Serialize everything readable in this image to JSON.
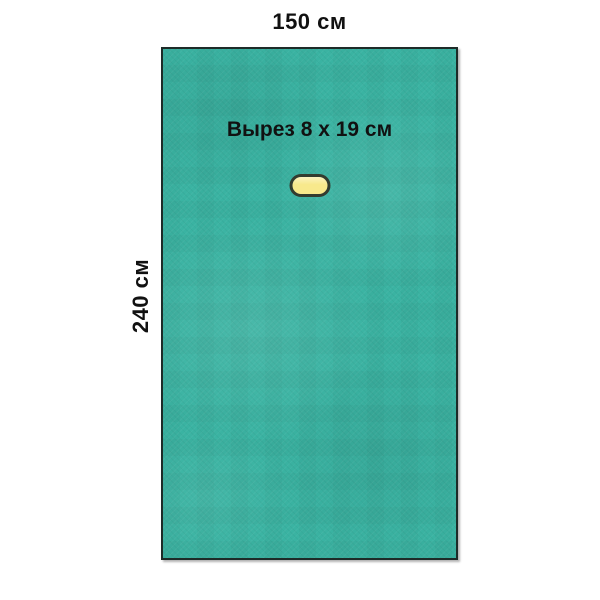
{
  "figure": {
    "top_label": "150 см",
    "side_label": "240 см",
    "cutout_label": "Вырез 8 x 19 см",
    "colors": {
      "background": "#ffffff",
      "drape": "#3ab3a2",
      "drape_border": "#1d2b28",
      "cutout_fill": "#f8e98c",
      "cutout_border": "#333c2f",
      "text": "#111111"
    }
  }
}
